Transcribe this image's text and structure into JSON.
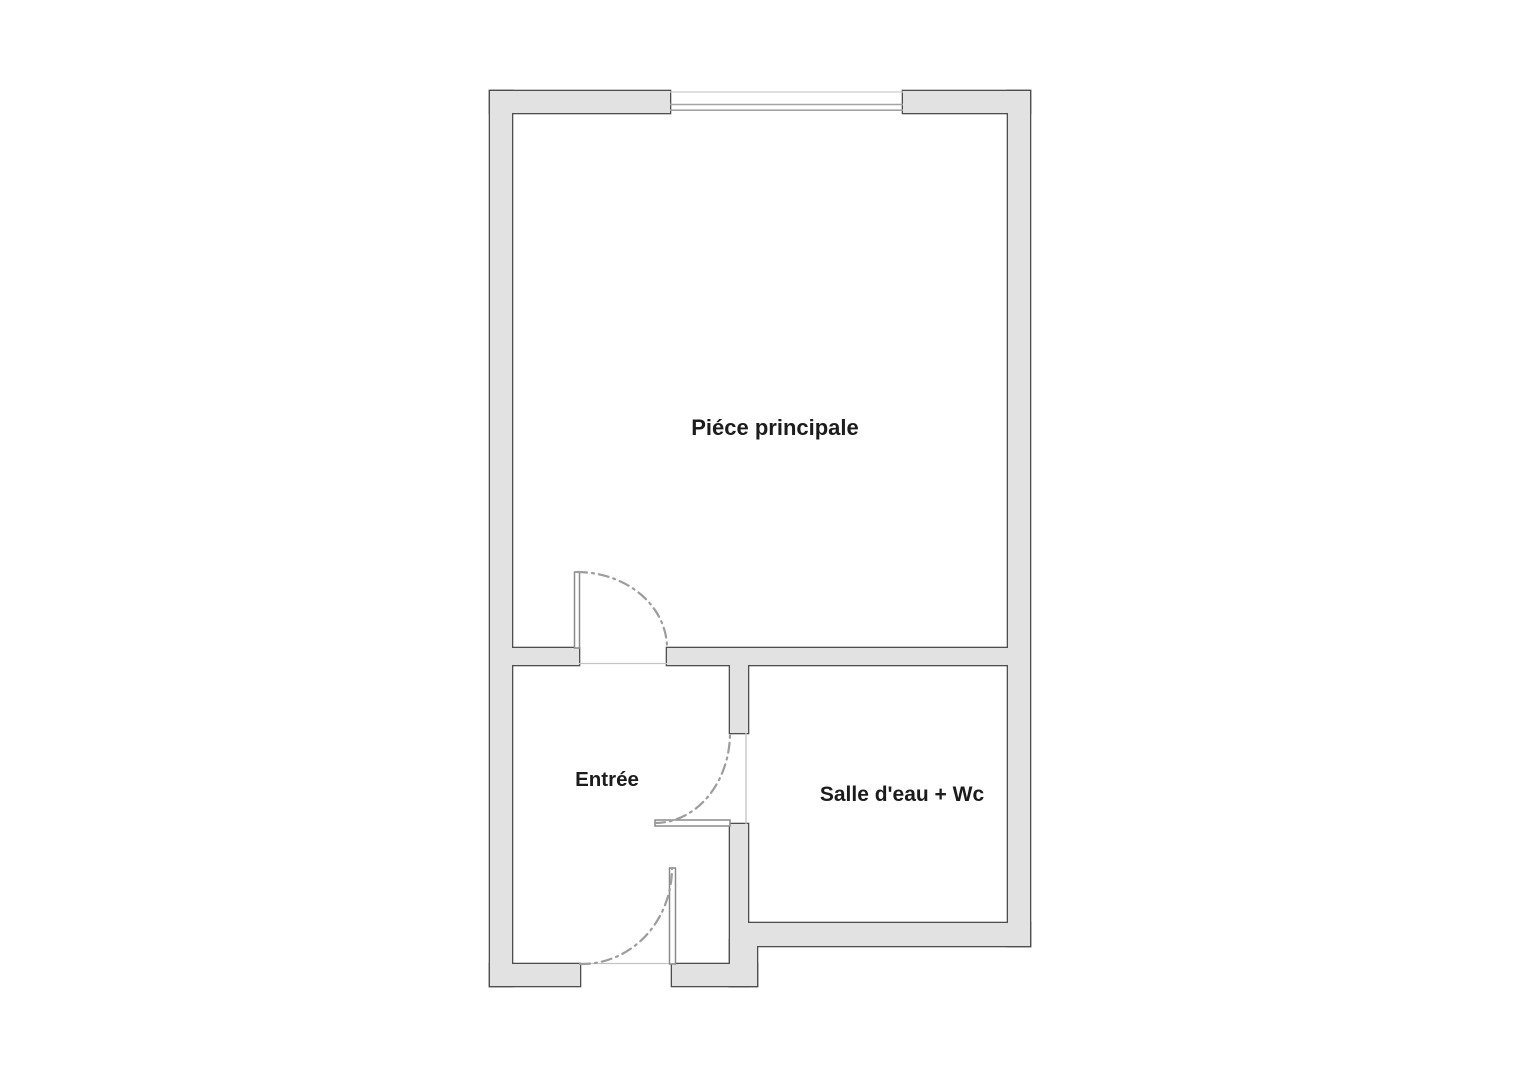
{
  "plan": {
    "type": "floor-plan",
    "background_color": "#ffffff",
    "wall_fill_color": "#e2e2e2",
    "wall_border_color": "#4e4e4e",
    "door_arc_color": "#9d9d9d",
    "label_color": "#1c1c1c",
    "rooms": [
      {
        "id": "piece-principale",
        "label": "Piéce principale"
      },
      {
        "id": "entree",
        "label": "Entrée"
      },
      {
        "id": "salle-deau-wc",
        "label": "Salle d'eau + Wc"
      }
    ],
    "features": {
      "window": "window-top-wall",
      "doors": [
        "door-main-room",
        "door-salle-deau",
        "door-entry"
      ]
    }
  }
}
